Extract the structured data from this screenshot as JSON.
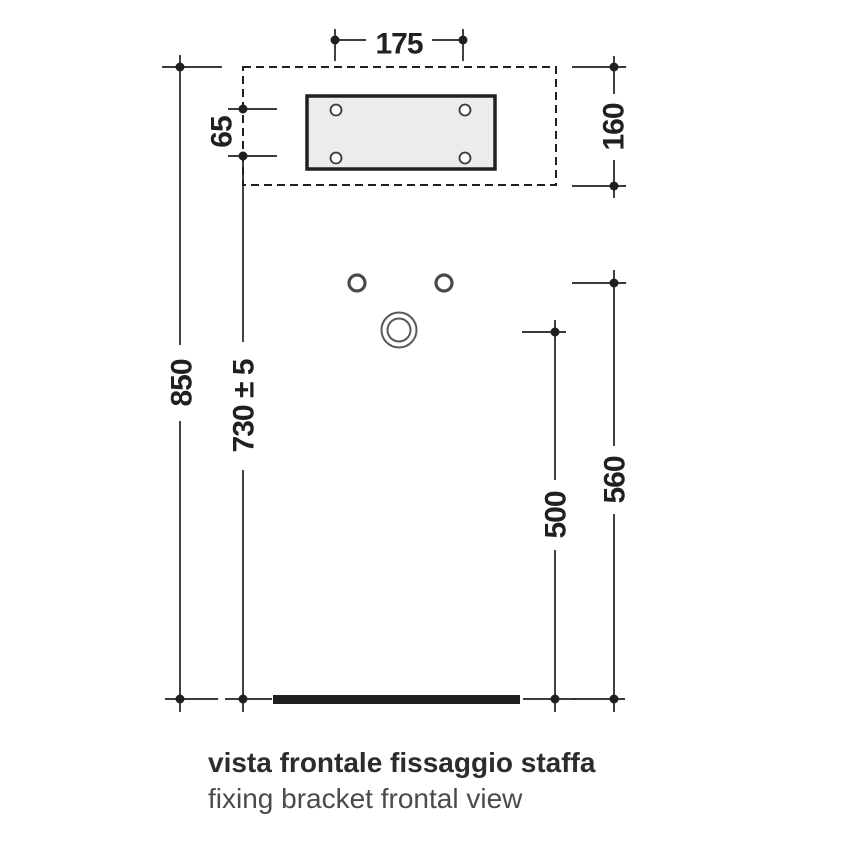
{
  "diagram": {
    "caption": {
      "title": "vista frontale fissaggio staffa",
      "subtitle": "fixing bracket frontal view"
    },
    "dimensions": {
      "hole_spacing_horizontal": "175",
      "hole_spacing_vertical": "65",
      "bracket_zone_height": "160",
      "total_height": "850",
      "bracket_holes_height": "730 ± 5",
      "upper_holes_height": "560",
      "outlet_height": "500"
    },
    "colors": {
      "line": "#231f20",
      "bracket_fill": "#ececec",
      "hole_stroke": "#4a4a4a",
      "outlet_stroke": "#58595b",
      "caption_title": "#2b2b30",
      "caption_subtitle": "#4a4a50"
    }
  }
}
